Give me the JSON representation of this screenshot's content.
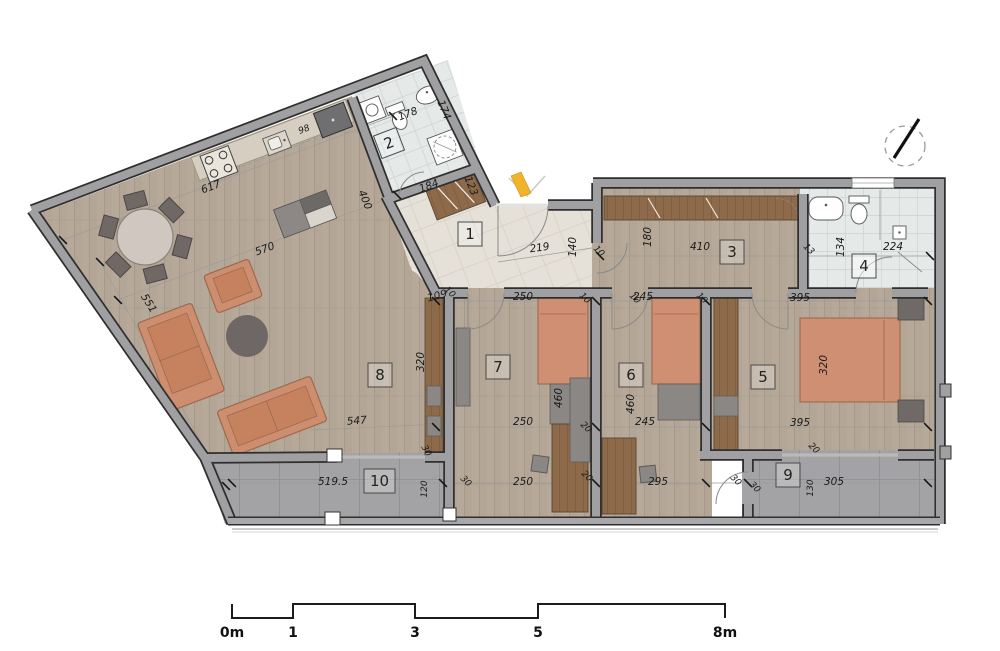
{
  "plan": {
    "type": "apartment-floor-plan",
    "room_numbers": [
      "1",
      "2",
      "3",
      "4",
      "5",
      "6",
      "7",
      "8",
      "9",
      "10"
    ],
    "dimension_labels": [
      "617",
      "570",
      "551",
      "98",
      "178",
      "174",
      "184",
      "123",
      "400",
      "219",
      "140",
      "410",
      "180",
      "13",
      "134",
      "224",
      "109",
      "250",
      "245",
      "395",
      "320",
      "320",
      "460",
      "460",
      "250",
      "245",
      "395",
      "547",
      "519.5",
      "250",
      "295",
      "305",
      "120",
      "130",
      "30",
      "30",
      "30",
      "30",
      "20",
      "20",
      "20",
      "10",
      "10",
      "10",
      "10",
      "10"
    ],
    "scale_bar": {
      "labels": [
        "0m",
        "1",
        "3",
        "5",
        "8m"
      ]
    },
    "colors": {
      "wall": "#a0a0a2",
      "wall_edge": "#2f2f2f",
      "wood_floor": "#b6a999",
      "bath_tile": "#e5e9e8",
      "hall_tile": "#e6e1d8",
      "balcony_tile": "#a3a3a5",
      "furniture_wood": "#8d6a4a",
      "upholstery": "#cd8d6f",
      "entry_accent": "#f0b429"
    }
  }
}
